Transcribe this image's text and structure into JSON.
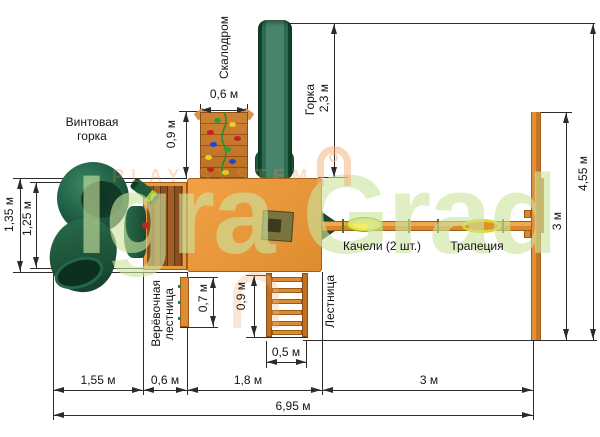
{
  "watermark": {
    "brand": "Igra Grad",
    "subtext": "PLAY SYSTEM"
  },
  "labels": {
    "spiral_slide": [
      "Винтовая",
      "горка"
    ],
    "climbing_wall": "Скалодром",
    "slide": [
      "Горка",
      "2,3 м"
    ],
    "swings": "Качели (2 шт.)",
    "trapeze": "Трапеция",
    "ladder": "Лестница",
    "rope_ladder": [
      "Верёвочная",
      "лестница"
    ]
  },
  "dimensions": {
    "wall_width": "0,6 м",
    "wall_height": "0,9 м",
    "platform_depth": "1,35 м",
    "bridge_depth": "1,25 м",
    "rope_ladder_height": "0,7 м",
    "ladder_height": "0,9 м",
    "ladder_width": "0,5 м",
    "spiral_zone_width": "1,55 м",
    "bridge_width": "0,6 м",
    "platform_width": "1,8 м",
    "swing_zone_width": "3 м",
    "frame_span": "3 м",
    "total_depth": "4,55 м",
    "total_width": "6,95 м"
  },
  "colors": {
    "wood_light": "#e2953c",
    "wood_dark": "#8a4e20",
    "slide_green": "#1d5c3c",
    "seat_yellow": "#e8e13a",
    "watermark_green": "#cde59f",
    "line": "#2b2b2b"
  }
}
